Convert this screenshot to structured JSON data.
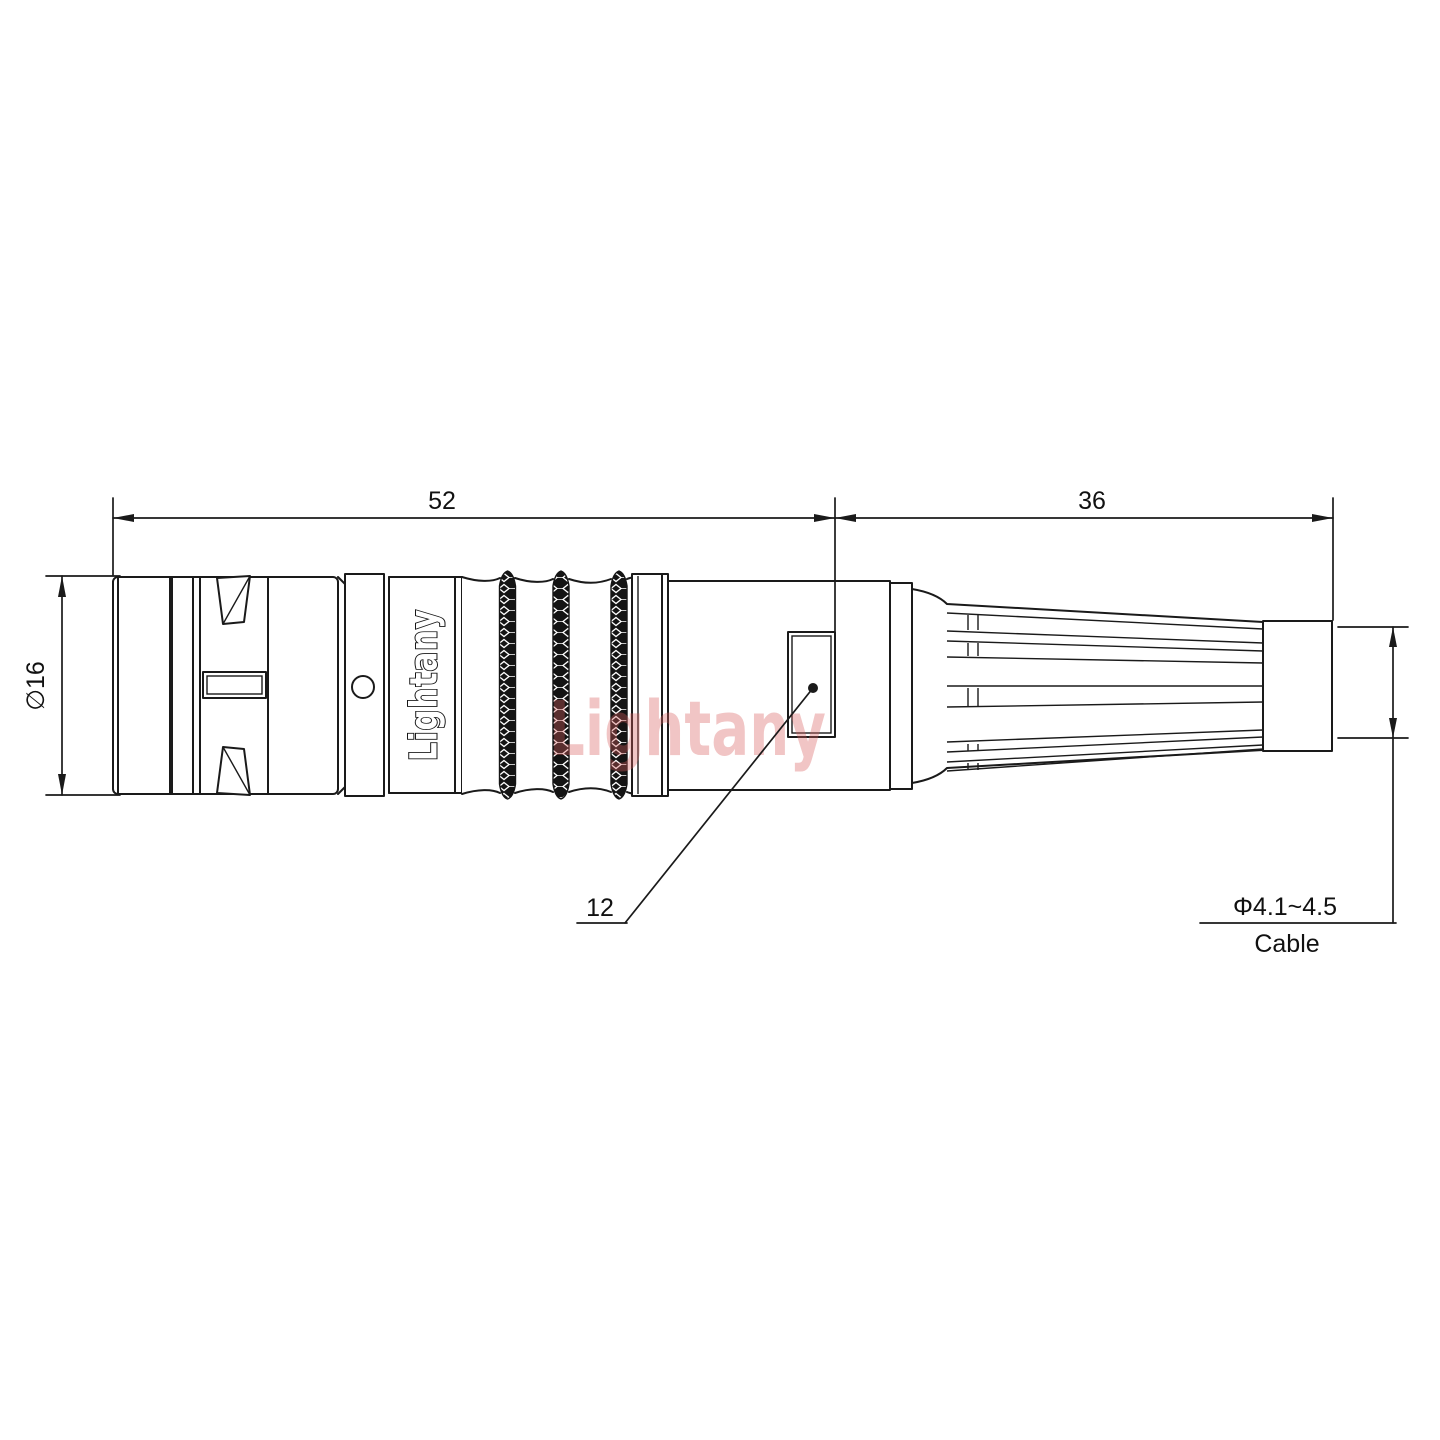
{
  "page": {
    "background": "#ffffff"
  },
  "drawing": {
    "watermark": {
      "text": "Lightany",
      "color": "#d95f5f"
    },
    "body_label": {
      "text": "Lightany"
    },
    "line_color": "#1a1a1a",
    "dimensions": {
      "body_length": {
        "value": "52"
      },
      "boot_length": {
        "value": "36"
      },
      "body_diameter": {
        "value": "∅16"
      },
      "window_detail": {
        "value": "12"
      },
      "cable": {
        "diameter": "Φ4.1~4.5",
        "label": "Cable"
      }
    }
  }
}
